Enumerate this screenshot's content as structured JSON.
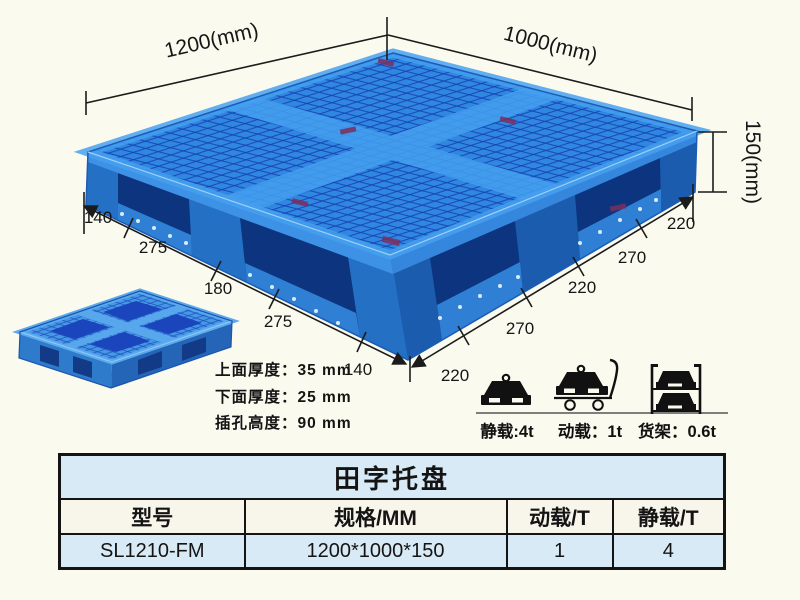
{
  "colors": {
    "background": "#fafaef",
    "pallet_blue": "#2f87df",
    "pallet_mesh_dark": "#1641b4",
    "pallet_wall_left": "#2d7bd0",
    "pallet_wall_right": "#2166bd",
    "pallet_opening_dark": "#0d347e",
    "table_row_blue": "#d8eaf5",
    "table_header_cream": "#f8f5eb",
    "line_black": "#1b1b1b"
  },
  "diagram": {
    "width_label": "1200(mm)",
    "depth_label": "1000(mm)",
    "height_label": "150(mm)",
    "left_dim_chain": [
      "140",
      "275",
      "180",
      "275",
      "140"
    ],
    "right_dim_chain": [
      "220",
      "270",
      "220",
      "270",
      "220"
    ],
    "notes": [
      "上面厚度：35 mm",
      "下面厚度：25 mm",
      "插孔高度：90 mm"
    ],
    "load_ratings": [
      {
        "icon": "static-load-weight-icon",
        "label": "静载:4t"
      },
      {
        "icon": "dynamic-load-trolley-icon",
        "label": "动载：1t"
      },
      {
        "icon": "rack-load-shelf-icon",
        "label": "货架：0.6t"
      }
    ]
  },
  "spec_table": {
    "title": "田字托盘",
    "headers": [
      "型号",
      "规格/MM",
      "动载/T",
      "静载/T"
    ],
    "rows": [
      [
        "SL1210-FM",
        "1200*1000*150",
        "1",
        "4"
      ]
    ]
  }
}
